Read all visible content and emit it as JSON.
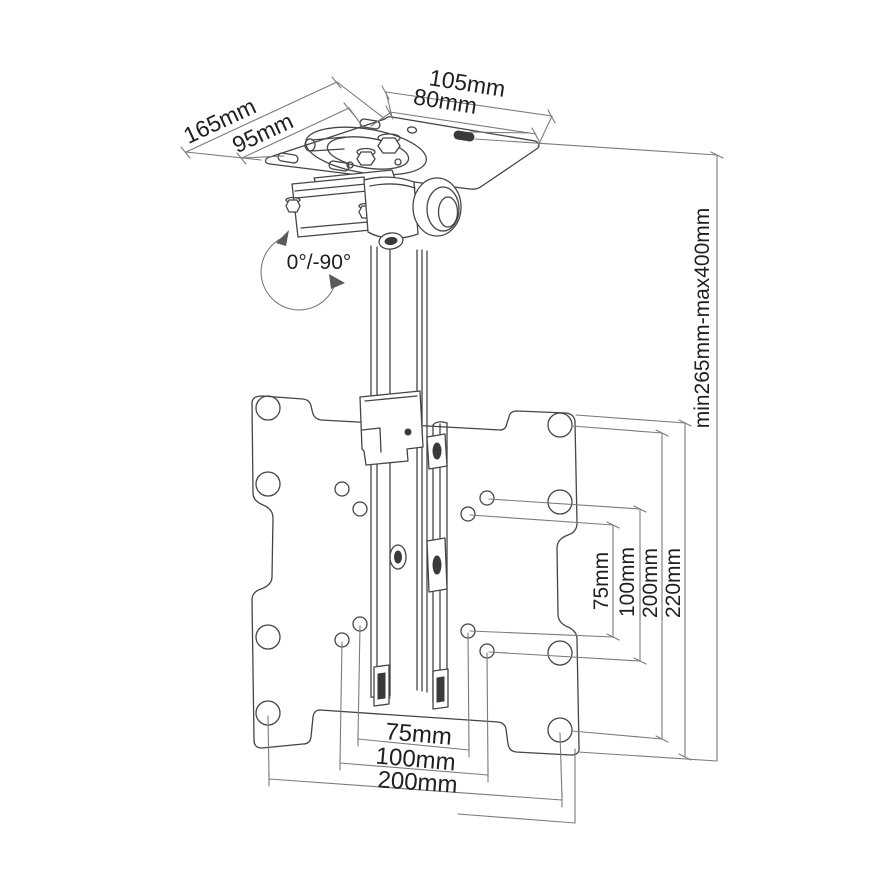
{
  "diagram": {
    "subject": "ceiling-tv-mount-dimension-drawing",
    "colors": {
      "background": "#ffffff",
      "drawing_line": "#454545",
      "dimension_line": "#7b7b7b",
      "label_text": "#1f1f1f"
    },
    "dimensions": {
      "ceiling_plate": {
        "width_outer": "105mm",
        "width_holes": "80mm",
        "depth_outer": "165mm",
        "depth_holes": "95mm"
      },
      "tilt_angle": "0°/-90°",
      "height_range": "min265mm-max400mm",
      "vesa_vertical": [
        "75mm",
        "100mm",
        "200mm",
        "220mm"
      ],
      "vesa_horizontal": [
        "75mm",
        "100mm",
        "200mm"
      ]
    }
  }
}
